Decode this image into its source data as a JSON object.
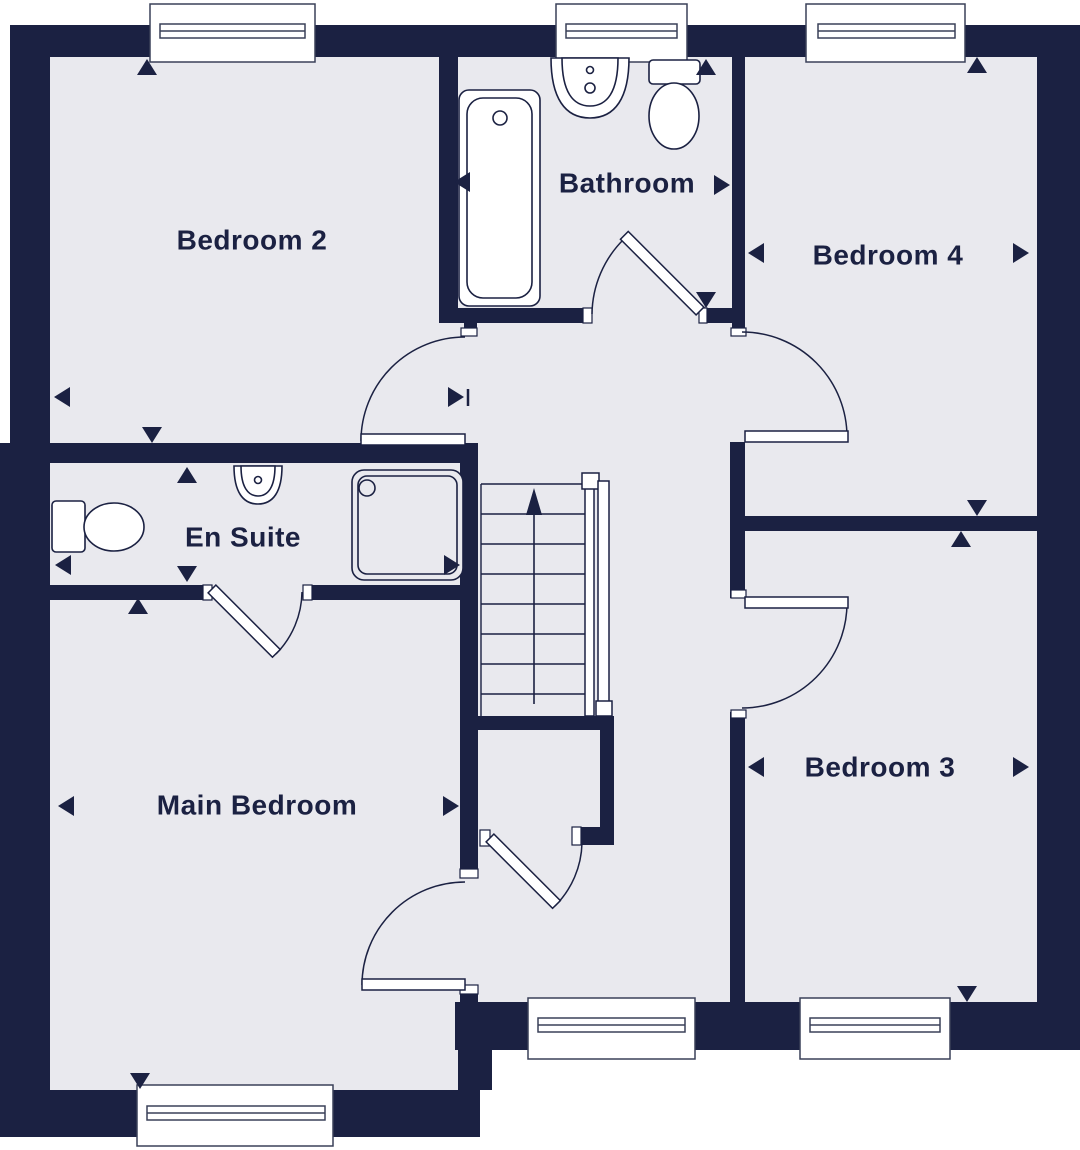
{
  "colors": {
    "wall": "#1b2142",
    "floor": "#e9e9ee",
    "line": "#1b2142",
    "background": "#ffffff"
  },
  "rooms": [
    {
      "id": "bedroom2",
      "label": "Bedroom 2",
      "fixtures": []
    },
    {
      "id": "bathroom",
      "label": "Bathroom",
      "fixtures": [
        "bath",
        "basin",
        "toilet"
      ]
    },
    {
      "id": "bedroom4",
      "label": "Bedroom 4",
      "fixtures": []
    },
    {
      "id": "ensuite",
      "label": "En Suite",
      "fixtures": [
        "toilet",
        "basin",
        "shower"
      ]
    },
    {
      "id": "main_bedroom",
      "label": "Main Bedroom",
      "fixtures": []
    },
    {
      "id": "bedroom3",
      "label": "Bedroom 3",
      "fixtures": []
    }
  ],
  "stairs": {
    "direction": "up"
  },
  "window_count": 6,
  "door_count": 7
}
